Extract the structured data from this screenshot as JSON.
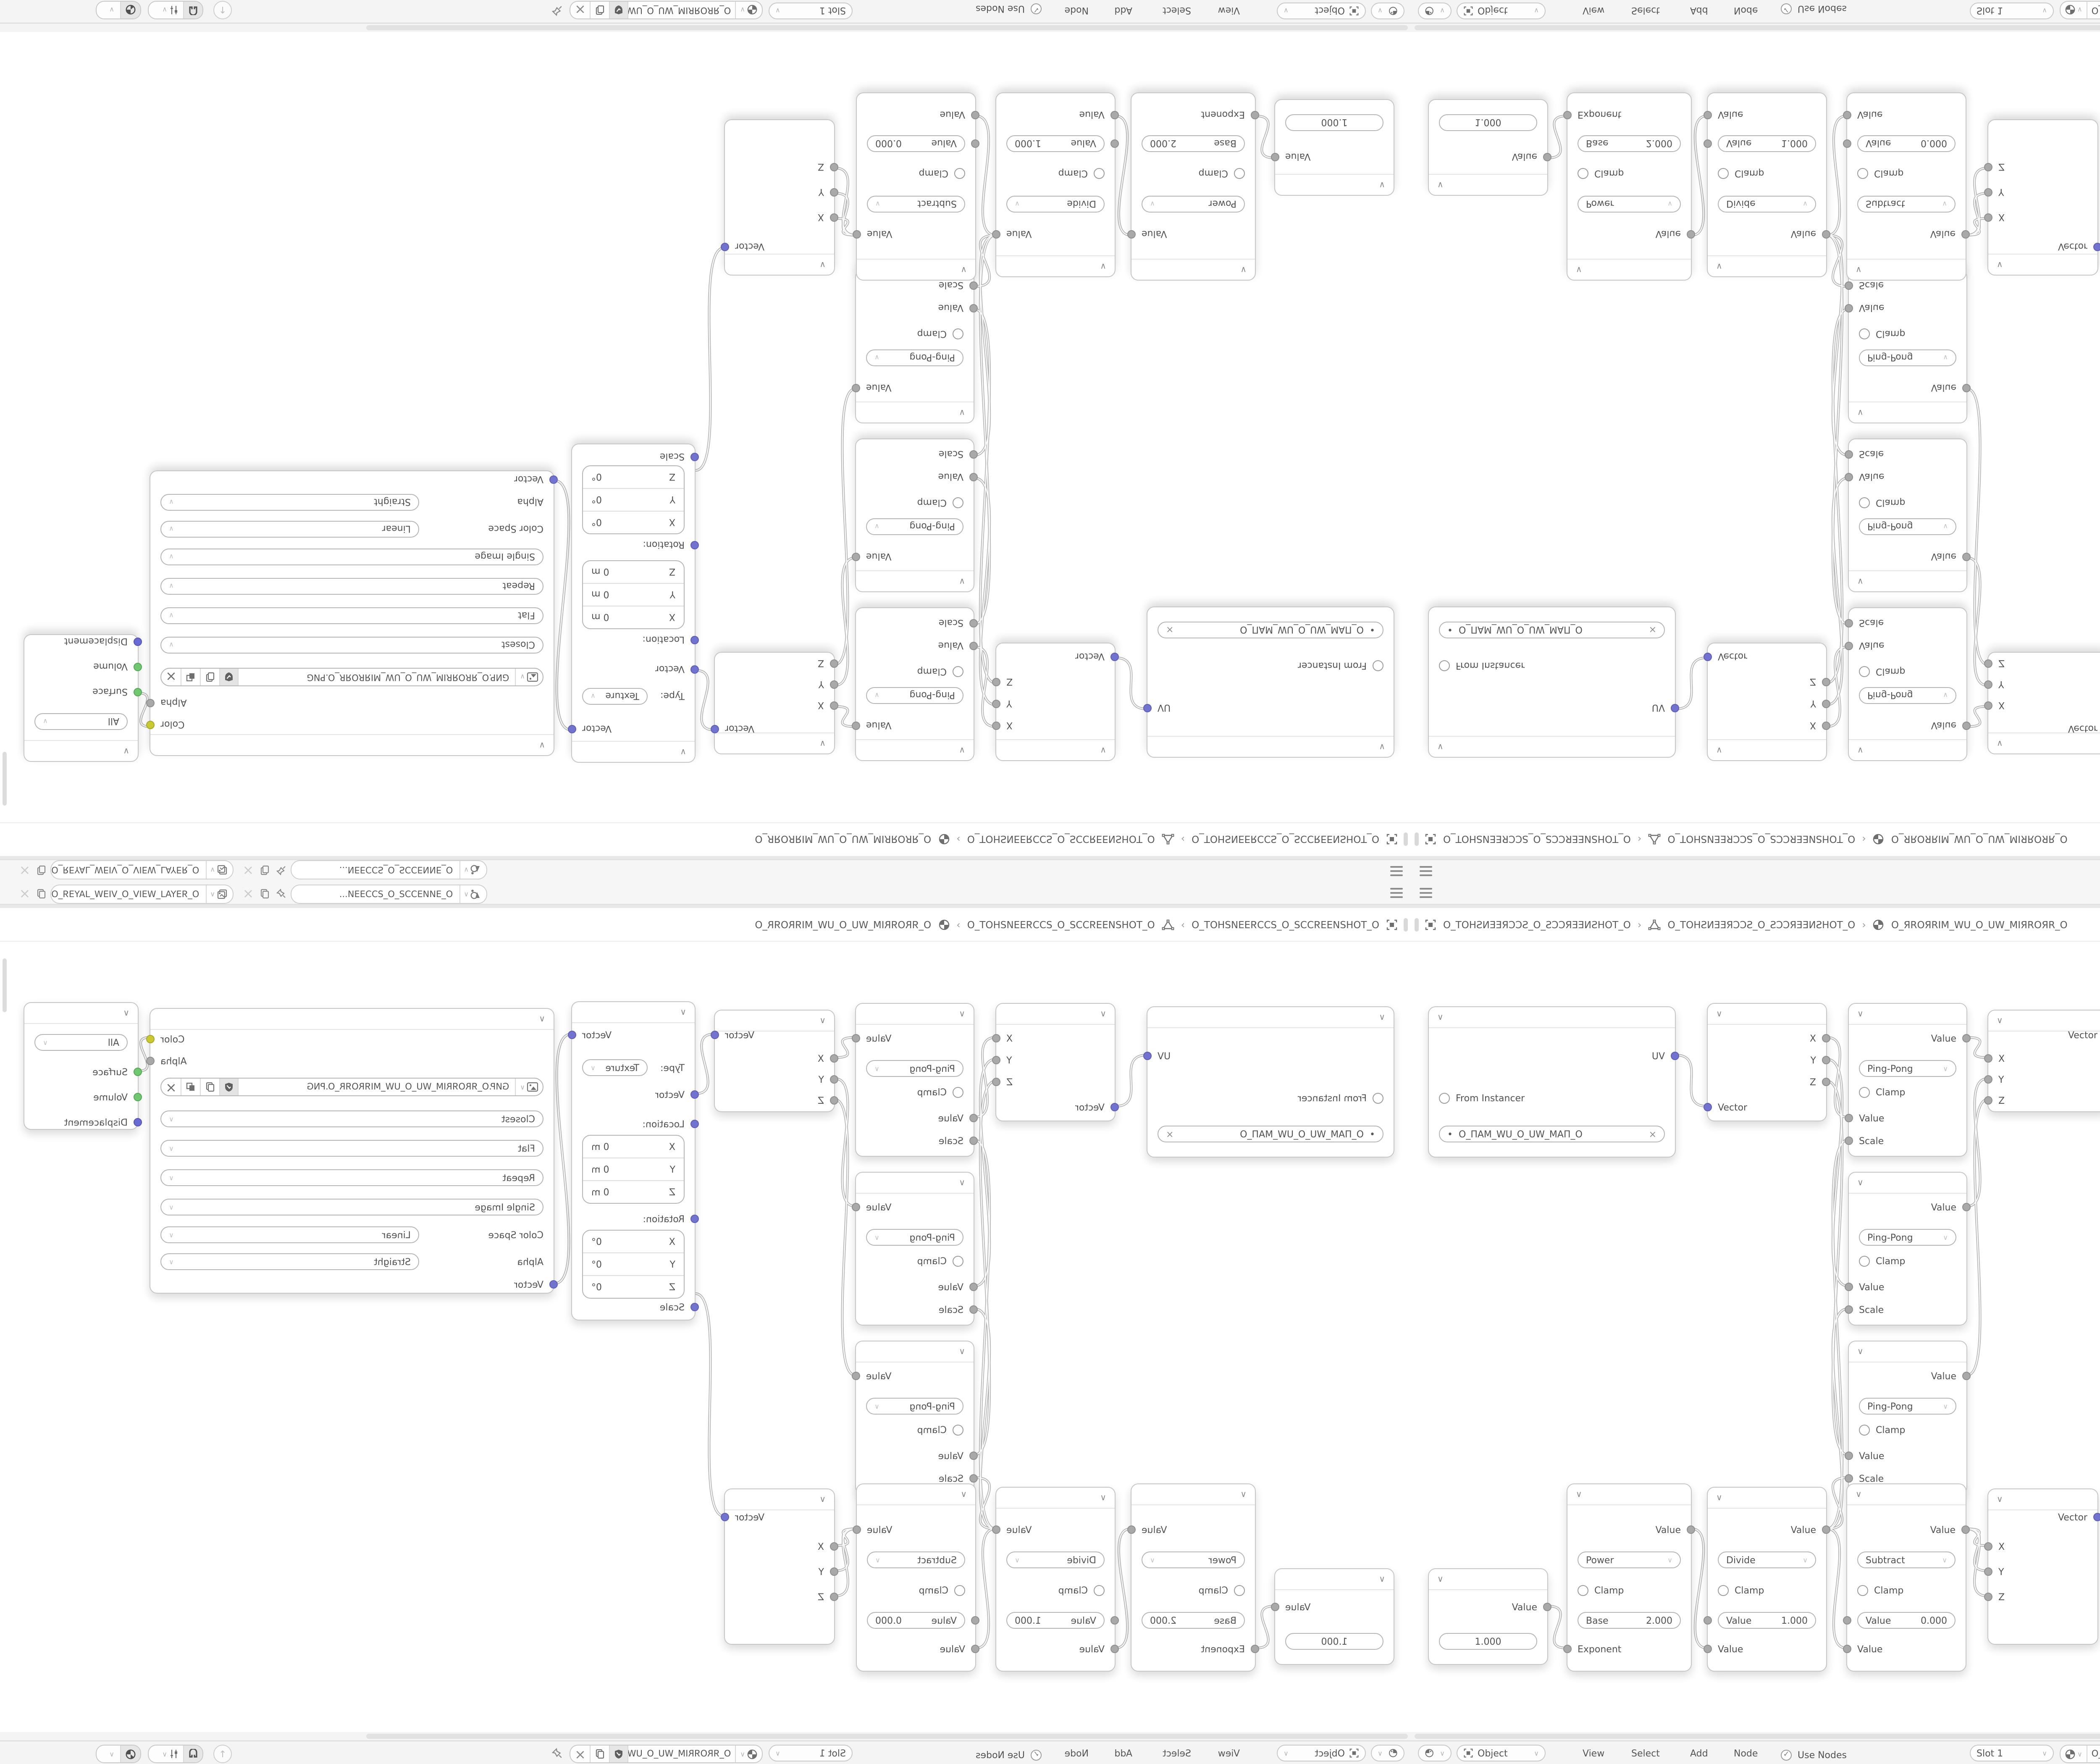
{
  "accent_colors": {
    "socket_value": "#a9a9a9",
    "socket_vector": "#7173cf",
    "socket_color": "#c9c932",
    "socket_shader": "#6fc76f",
    "socket_displacement": "#6a6ad4"
  },
  "topbar": {
    "scene_name": "O_ƎИИƎƆƆƧ_O_ƧƆƆƎƎИ...",
    "view_layer_name": "O_ЯƎYA⅃_WƎIV_O_VIƎW_⅃AYƎЯ_O"
  },
  "breadcrumb": {
    "object_name": "O_TOHƧИƎƎЯƆƆƧ_O_ƧƆƆЯƎƎИƧHOT_O",
    "mesh_name": "O_TOHƧИƎƎЯƆƆƧ_O_ƧƆƆЯƎƎИƧHOT_O",
    "material_name": "O_ЯROЯRIM_WU_O_UW_MIЯROЯR_O",
    "sep": "›"
  },
  "editor_header": {
    "mode": "Object",
    "menu_view": "View",
    "menu_select": "Select",
    "menu_add": "Add",
    "menu_node": "Node",
    "use_nodes": "Use Nodes",
    "slot": "Slot 1",
    "material_name": "O_ЯROЯRIM_WU_O_UW_MIЯROЯR_O",
    "check": "✓"
  },
  "nodes": {
    "uv_map": {
      "out": "UV",
      "from_instancer": "From Instancer",
      "uv_name": "O_ПAM_WU_O_UW_MAП_O",
      "dot": "•",
      "clear": "×"
    },
    "separate_xyz": {
      "out_x": "X",
      "out_y": "Y",
      "out_z": "Z",
      "in_vector": "Vector"
    },
    "math_pingpong": {
      "out": "Value",
      "op": "Ping-Pong",
      "clamp": "Clamp",
      "in1": "Value",
      "in2": "Scale"
    },
    "combine_xyz": {
      "out": "Vector",
      "in_x": "X",
      "in_y": "Y",
      "in_z": "Z"
    },
    "mapping": {
      "out": "Vector",
      "type_label": "Type:",
      "type_value": "Texture",
      "in_vector": "Vector",
      "location_label": "Location:",
      "rotation_label": "Rotation:",
      "scale_label": "Scale",
      "axis_x": "X",
      "axis_y": "Y",
      "axis_z": "Z",
      "loc_value": "0 m",
      "rot_value": "0°"
    },
    "image_texture": {
      "out_color": "Color",
      "out_alpha": "Alpha",
      "filename": "GИP.O_ЯROЯRIM_WU_O_UW_MIЯROЯR_O.PNG",
      "interpolation": "Closest",
      "projection": "Flat",
      "extension": "Repeat",
      "source": "Single Image",
      "color_space_label": "Color Space",
      "color_space_value": "Linear",
      "alpha_label": "Alpha",
      "alpha_value": "Straight",
      "in_vector": "Vector",
      "clear": "×"
    },
    "material_output": {
      "target": "All",
      "in_surface": "Surface",
      "in_volume": "Volume",
      "in_displacement": "Displacement"
    },
    "value": {
      "out": "Value",
      "value": "1.000"
    },
    "math_power": {
      "out": "Value",
      "op": "Power",
      "clamp": "Clamp",
      "in1_label": "Base",
      "in1_value": "2.000",
      "in2": "Exponent"
    },
    "math_divide": {
      "out": "Value",
      "op": "Divide",
      "clamp": "Clamp",
      "in1_label": "Value",
      "in1_value": "1.000",
      "in2": "Value"
    },
    "math_subtract": {
      "out": "Value",
      "op": "Subtract",
      "clamp": "Clamp",
      "in1_label": "Value",
      "in1_value": "0.000",
      "in2": "Value"
    }
  }
}
